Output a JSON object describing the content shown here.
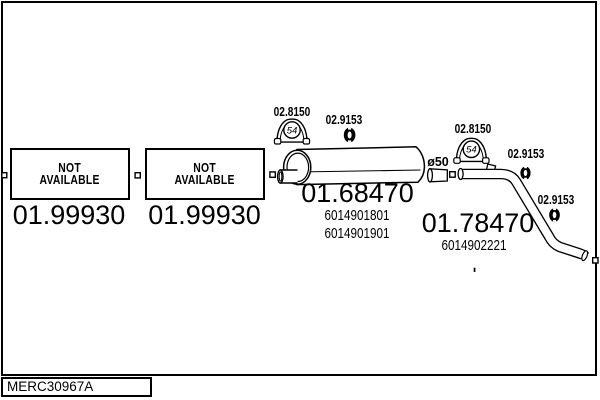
{
  "diagram": {
    "drawing_code": "MERC30967A",
    "colors": {
      "ink": "#000000",
      "paper": "#ffffff"
    },
    "boxes": [
      {
        "title_line1": "NOT",
        "title_line2": "AVAILABLE",
        "part_number": "01.99930"
      },
      {
        "title_line1": "NOT",
        "title_line2": "AVAILABLE",
        "part_number": "01.99930"
      }
    ],
    "muffler": {
      "part_number": "01.68470",
      "oe_codes": [
        "6014901801",
        "6014901901"
      ],
      "diameter_label": "ø50",
      "clamp_label": "02.8150",
      "clamp_badge": "54",
      "hanger_label": "02.9153"
    },
    "tailpipe": {
      "part_number": "01.78470",
      "oe_code": "6014902221",
      "clamp_label": "02.8150",
      "clamp_badge": "54",
      "hanger_label_upper": "02.9153",
      "hanger_label_lower": "02.9153"
    }
  }
}
